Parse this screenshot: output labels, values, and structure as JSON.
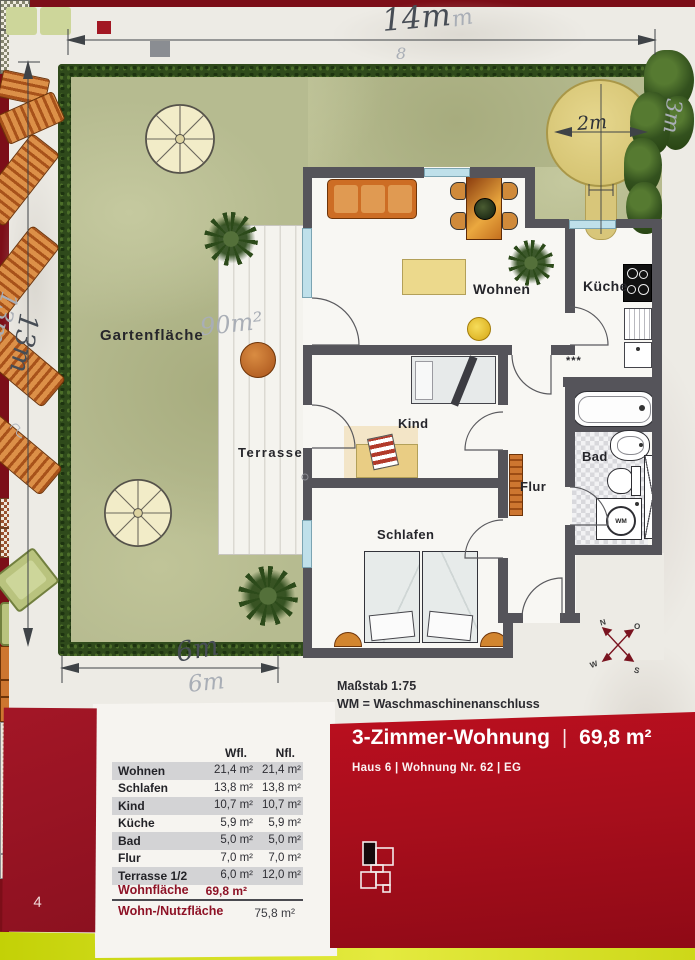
{
  "plan": {
    "dimensions": {
      "top": "14m",
      "top_faint_m": "m",
      "top_faint_8": "8",
      "left": "13m",
      "left_pencil": "13m",
      "bottom": "6m",
      "bottom_pencil": "6m",
      "tree": "2m",
      "right_pencil": "3m",
      "garden_area_pencil": "90m²"
    },
    "labels": {
      "garden": "Gartenfläche",
      "terrace": "Terrasse",
      "living": "Wohnen",
      "kitchen": "Küche",
      "child": "Kind",
      "bedroom": "Schlafen",
      "bath": "Bad",
      "hall": "Flur",
      "washer": "WM",
      "kitchen_stars": "***"
    },
    "compass": {
      "north": "N",
      "east": "O",
      "south": "S",
      "west": "W"
    }
  },
  "notes": {
    "scale": "Maßstab 1:75",
    "legend": "WM = Waschmaschinenanschluss"
  },
  "banner": {
    "title": "3-Zimmer-Wohnung",
    "separator": "|",
    "area": "69,8 m²",
    "subtitle": "Haus 6  |  Wohnung Nr. 62  |  EG"
  },
  "table": {
    "headers": {
      "wfl": "Wfl.",
      "nfl": "Nfl."
    },
    "rows": [
      {
        "label": "Wohnen",
        "wfl": "21,4 m²",
        "nfl": "21,4 m²"
      },
      {
        "label": "Schlafen",
        "wfl": "13,8 m²",
        "nfl": "13,8 m²"
      },
      {
        "label": "Kind",
        "wfl": "10,7 m²",
        "nfl": "10,7 m²"
      },
      {
        "label": "Küche",
        "wfl": "5,9 m²",
        "nfl": "5,9 m²"
      },
      {
        "label": "Bad",
        "wfl": "5,0 m²",
        "nfl": "5,0 m²"
      },
      {
        "label": "Flur",
        "wfl": "7,0 m²",
        "nfl": "7,0 m²"
      },
      {
        "label": "Terrasse 1/2",
        "wfl": "6,0 m²",
        "nfl": "12,0 m²"
      }
    ],
    "summary": [
      {
        "label": "Wohnfläche",
        "wfl": "69,8 m²",
        "nfl": ""
      },
      {
        "label": "Wohn-/Nutzfläche",
        "wfl": "",
        "nfl": "75,8 m²"
      }
    ]
  },
  "page": {
    "number": "4"
  },
  "colors": {
    "banner_red": "#b11221",
    "dark_red": "#8e1226",
    "page": "#edebe5",
    "garden": "#b6bb90",
    "hedge": "#2f4a1b",
    "wall": "#55545a",
    "accent_yellow": "#d8e32a"
  }
}
